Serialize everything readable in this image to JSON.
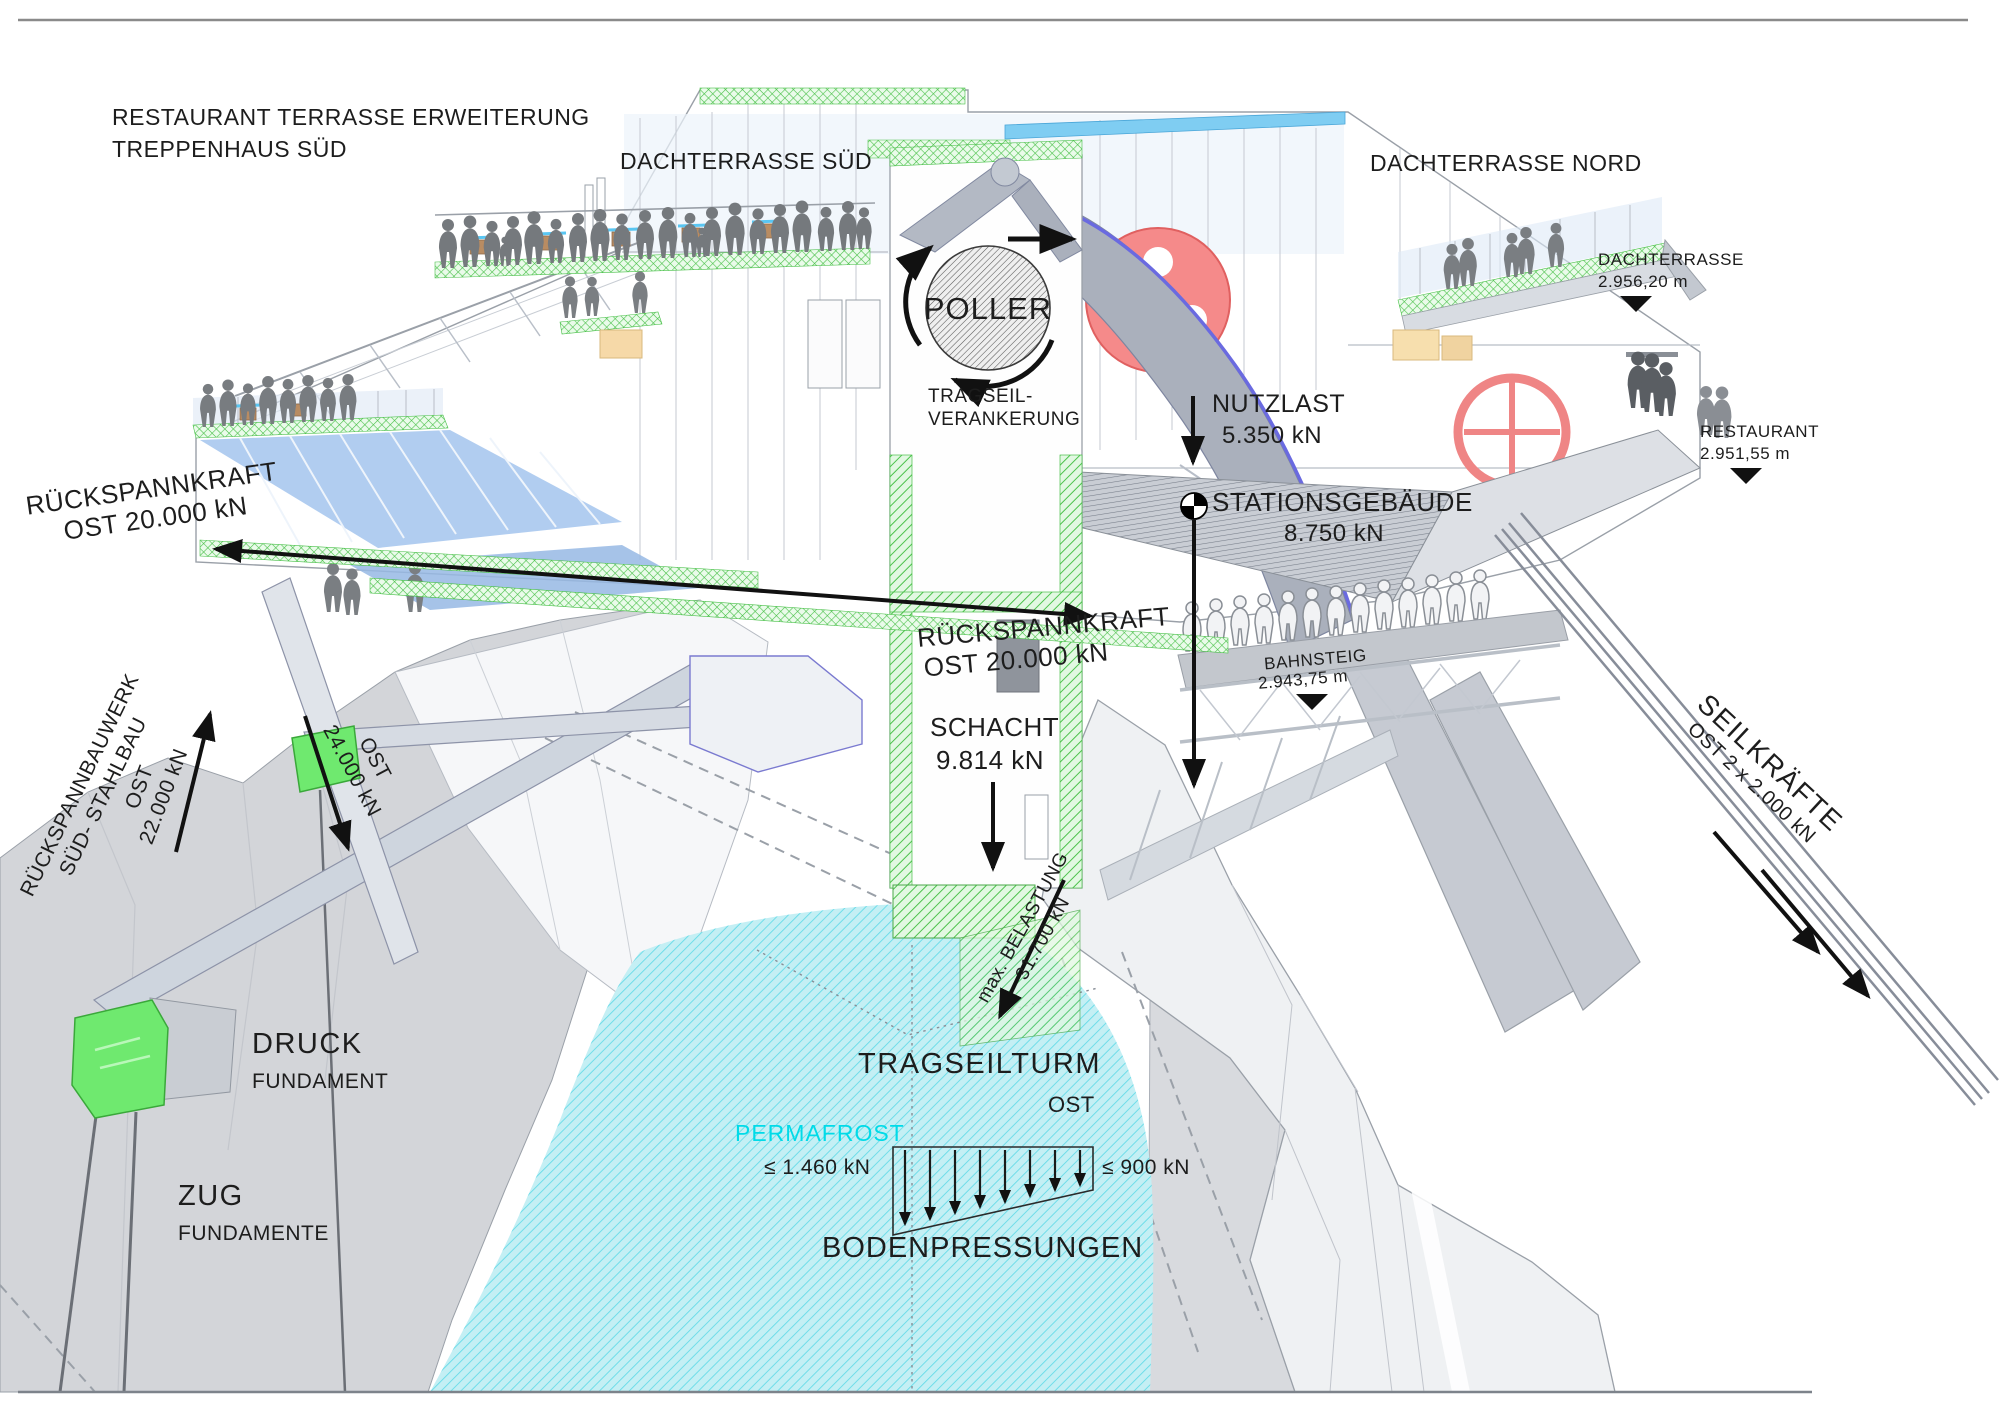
{
  "annotations": {
    "top_left": {
      "line1": "RESTAURANT TERRASSE ERWEITERUNG",
      "line2": "TREPPENHAUS SÜD"
    },
    "dachterrasse_sued": "DACHTERRASSE SÜD",
    "dachterrasse_nord": "DACHTERRASSE NORD",
    "poller": {
      "title": "POLLER",
      "sub1": "TRAGSEIL-",
      "sub2": "VERANKERUNG"
    },
    "loads": {
      "nutzlast": {
        "name": "NUTZLAST",
        "value": "5.350 kN"
      },
      "stationsgebaeude": {
        "name": "STATIONSGEBÄUDE",
        "value": "8.750 kN"
      },
      "schacht": {
        "name": "SCHACHT",
        "value": "9.814 kN"
      },
      "max_belastung": {
        "name": "max. BELASTUNG",
        "value": "31.700 kN"
      }
    },
    "elevation_markers": {
      "dachterrasse": {
        "name": "DACHTERRASSE",
        "value": "2.956,20 m"
      },
      "restaurant": {
        "name": "RESTAURANT",
        "value": "2.951,55 m"
      },
      "bahnsteig": {
        "name": "BAHNSTEIG",
        "value": "2.943,75 m"
      }
    },
    "forces": {
      "rueckspann_left": {
        "name": "RÜCKSPANNKRAFT",
        "value": "OST 20.000 kN"
      },
      "rueckspann_mid": {
        "name": "RÜCKSPANNKRAFT",
        "value": "OST 20.000 kN"
      },
      "ost22": {
        "name": "OST",
        "value": "22.000 kN"
      },
      "ost24": {
        "name": "OST",
        "value": "24.000 kN"
      },
      "seilkraefte": {
        "name": "SEILKRÄFTE",
        "value": "OST 2 x 2.000 kN"
      }
    },
    "structures": {
      "rueckspannbauwerk": {
        "line1": "RÜCKSPANNBAUWERK",
        "line2": "SÜD- STAHLBAU"
      },
      "druck": {
        "name": "DRUCK",
        "sub": "FUNDAMENT"
      },
      "zug": {
        "name": "ZUG",
        "sub": "FUNDAMENTE"
      },
      "tragseilturm": {
        "name": "TRAGSEILTURM",
        "sub": "OST"
      },
      "permafrost": "PERMAFROST"
    },
    "bodenpressungen": {
      "title": "BODENPRESSUNGEN",
      "left": "≤ 1.460 kN",
      "right": "≤ 900 kN"
    }
  },
  "colors": {
    "permafrost_fill": "#c4eff4",
    "permafrost_hatch": "#66dbe8",
    "permafrost_text": "#00dbe8",
    "foundation_green": "#6fe96f",
    "hatch_green": "#4cc24c",
    "glass_blue": "#a9c8ee",
    "wheel_red": "#f58a8a",
    "cable_blue": "#6a6ae0"
  }
}
